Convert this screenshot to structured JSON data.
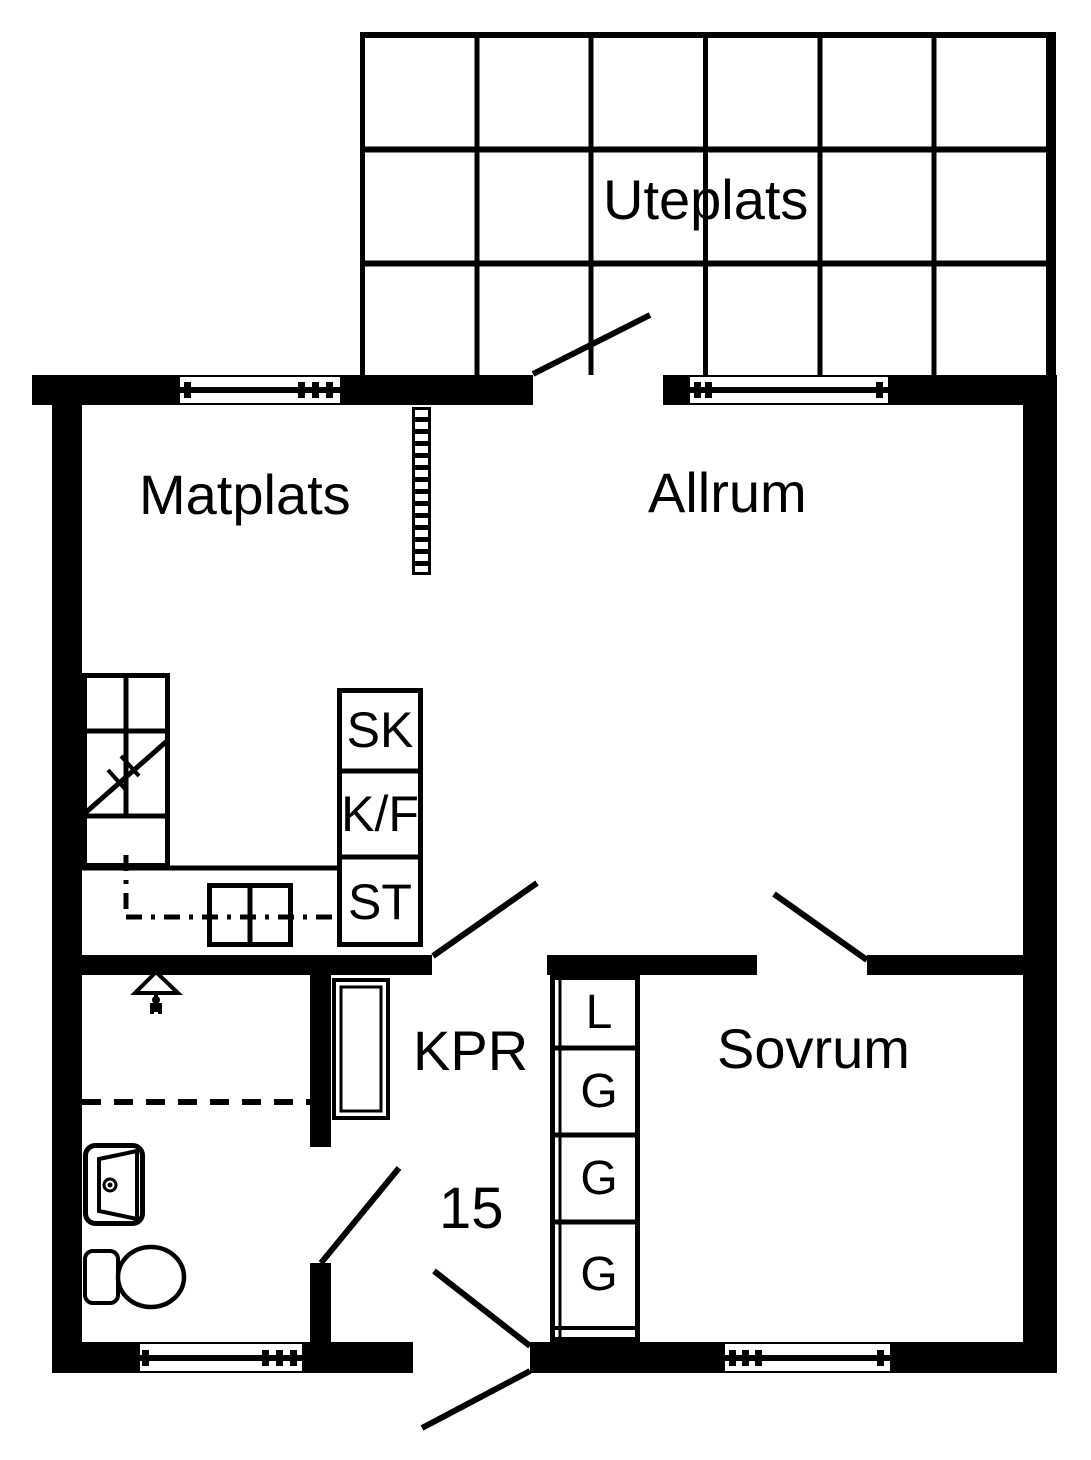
{
  "floorplan": {
    "unit_number": "15",
    "rooms": {
      "uteplats": {
        "label": "Uteplats"
      },
      "matplats": {
        "label": "Matplats"
      },
      "allrum": {
        "label": "Allrum"
      },
      "kpr": {
        "label": "KPR"
      },
      "sovrum": {
        "label": "Sovrum"
      }
    },
    "kitchen_units": {
      "sk": "SK",
      "kf": "K/F",
      "st": "ST"
    },
    "bedroom_wardrobes": [
      "L",
      "G",
      "G",
      "G"
    ],
    "fixture_icons": {
      "shower": "triangle-shower-symbol",
      "sink": "washbasin-symbol",
      "toilet": "toilet-symbol",
      "radiator": "hatched-ladder-strip",
      "stove": "stove-symbol",
      "counter": "kitchen-counter-with-sink-diagonal"
    },
    "colors": {
      "wall": "#000000",
      "floor": "#ffffff"
    }
  }
}
